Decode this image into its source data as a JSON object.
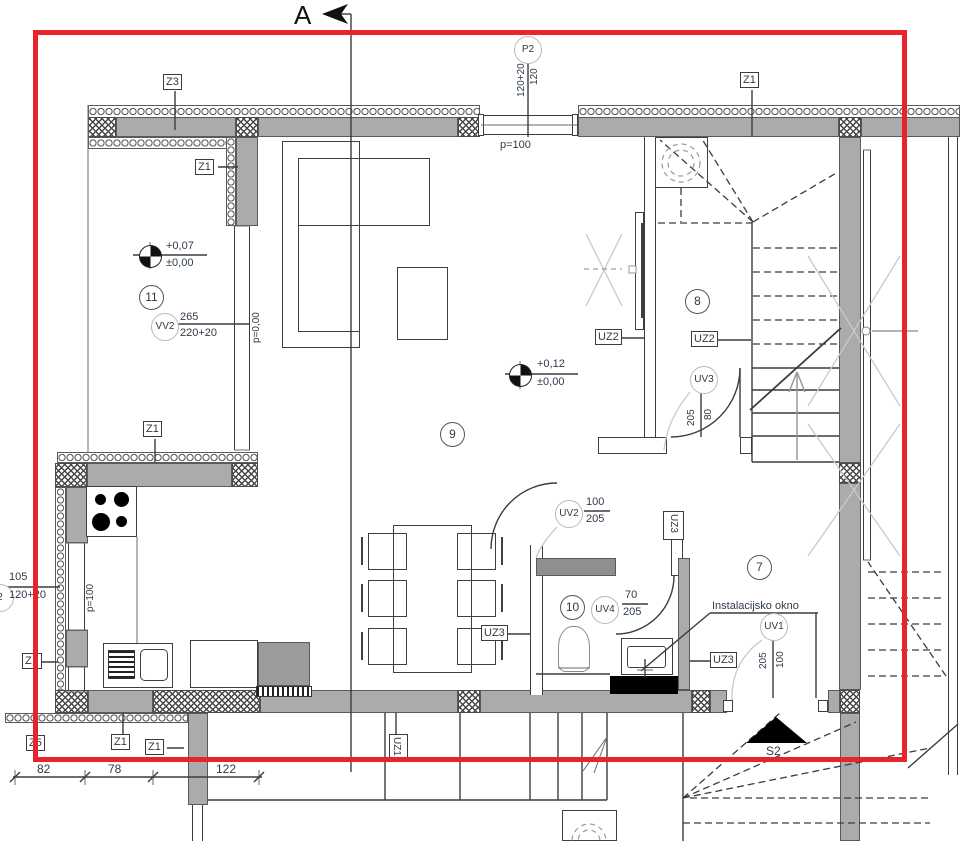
{
  "colors": {
    "red_box": "#e8232a",
    "wall_gray": "#ababab",
    "line": "#3c3c3c",
    "text_color": "#2e3b49",
    "light_line": "#c9c9c9"
  },
  "section": {
    "label": "A"
  },
  "rooms": {
    "r7": "7",
    "r8": "8",
    "r9": "9",
    "r10": "10",
    "r11": "11"
  },
  "levels": {
    "room11": {
      "above": "+0,07",
      "base": "±0,00"
    },
    "living": {
      "above": "+0,12",
      "base": "±0,00"
    }
  },
  "openings": {
    "p2": {
      "id": "P2",
      "num": "120",
      "den": "120+20",
      "parapet": "p=100"
    },
    "vv2": {
      "id": "VV2",
      "num": "265",
      "den": "220+20",
      "parapet": "p=0,00"
    },
    "left": {
      "id": "2",
      "num": "105",
      "den": "120+20",
      "parapet": "p=100"
    },
    "uv1": {
      "id": "UV1",
      "num": "100",
      "den": "205"
    },
    "uv2": {
      "id": "UV2",
      "num": "100",
      "den": "205"
    },
    "uv3": {
      "id": "UV3",
      "num": "80",
      "den": "205"
    },
    "uv4": {
      "id": "UV4",
      "num": "70",
      "den": "205"
    }
  },
  "wall_tags": {
    "z3": "Z3",
    "z1_room11": "Z1",
    "z1_kitchen": "Z1",
    "z1_topright": "Z1",
    "z1_bottom1": "Z1",
    "z1_bottom2": "Z1",
    "z5": "Z5",
    "z_partial": "Z",
    "uz1": "UZ1",
    "uz2_a": "UZ2",
    "uz2_b": "UZ2",
    "uz3_dining": "UZ3",
    "uz3_room7": "UZ3",
    "uz3_vert": "UZ3"
  },
  "annotations": {
    "install_window": "Instalacijsko okno",
    "stair_mark": "S2"
  },
  "dimensions": {
    "d1": "82",
    "d2": "78",
    "d3": "122"
  }
}
